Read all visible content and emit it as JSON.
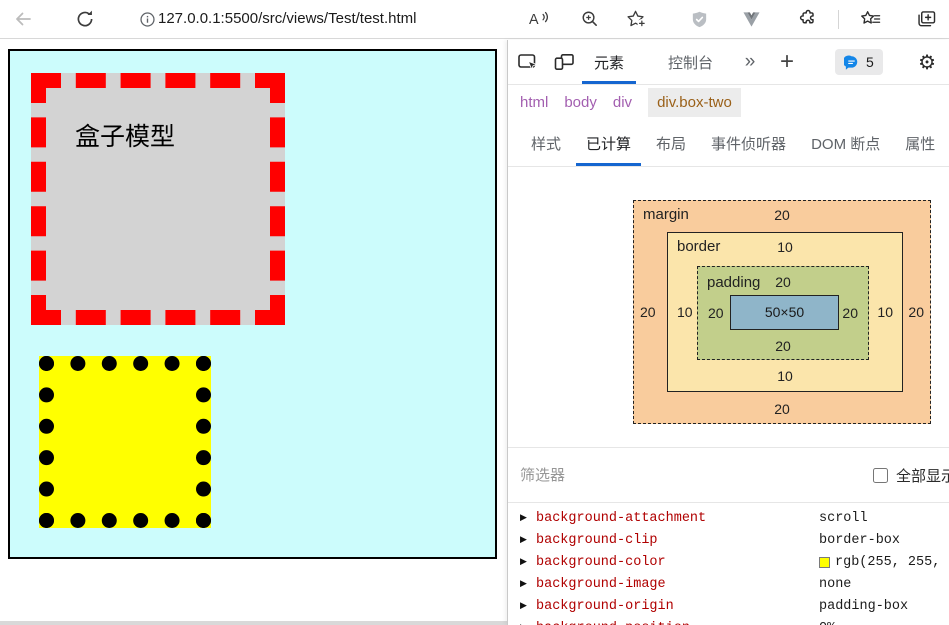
{
  "browser": {
    "url": "127.0.0.1:5500/src/views/Test/test.html"
  },
  "page": {
    "box_one_text": "盒子模型",
    "colors": {
      "container_background": "#ccfcfc",
      "box_one_background": "#d3d3d3",
      "box_one_border": "#ff0000",
      "box_two_background": "#ffff00",
      "box_two_border": "#000000"
    }
  },
  "devtools": {
    "accent_color": "#1566d0",
    "tabs": [
      {
        "label": "元素",
        "active": true
      },
      {
        "label": "控制台",
        "active": false
      }
    ],
    "more_tabs_glyph": "»",
    "add_tab_glyph": "+",
    "feedback_count": "5",
    "gear_glyph": "⚙",
    "breadcrumb": [
      "html",
      "body",
      "div",
      "div.box-two"
    ],
    "subtabs": [
      {
        "label": "样式",
        "active": false
      },
      {
        "label": "已计算",
        "active": true
      },
      {
        "label": "布局",
        "active": false
      },
      {
        "label": "事件侦听器",
        "active": false
      },
      {
        "label": "DOM 断点",
        "active": false
      },
      {
        "label": "属性",
        "active": false
      }
    ],
    "box_model": {
      "margin_label": "margin",
      "border_label": "border",
      "padding_label": "padding",
      "content_size": "50×50",
      "margin": {
        "top": "20",
        "right": "20",
        "bottom": "20",
        "left": "20"
      },
      "border": {
        "top": "10",
        "right": "10",
        "bottom": "10",
        "left": "10"
      },
      "padding": {
        "top": "20",
        "right": "20",
        "bottom": "20",
        "left": "20"
      },
      "colors": {
        "margin": "#f9cc9d",
        "border": "#fbe5ab",
        "padding": "#c2cf8b",
        "content": "#8fb5c9"
      }
    },
    "filter": {
      "placeholder": "筛选器",
      "show_all_label": "全部显示",
      "show_all_checked": false
    },
    "computed": {
      "expander_glyph": "▶",
      "name_color": "#b00000",
      "rows": [
        {
          "name": "background-attachment",
          "value": "scroll"
        },
        {
          "name": "background-clip",
          "value": "border-box"
        },
        {
          "name": "background-color",
          "value": "rgb(255, 255,",
          "swatch": "#ffff00"
        },
        {
          "name": "background-image",
          "value": "none"
        },
        {
          "name": "background-origin",
          "value": "padding-box"
        },
        {
          "name": "background-position",
          "value": "0%"
        }
      ]
    }
  }
}
